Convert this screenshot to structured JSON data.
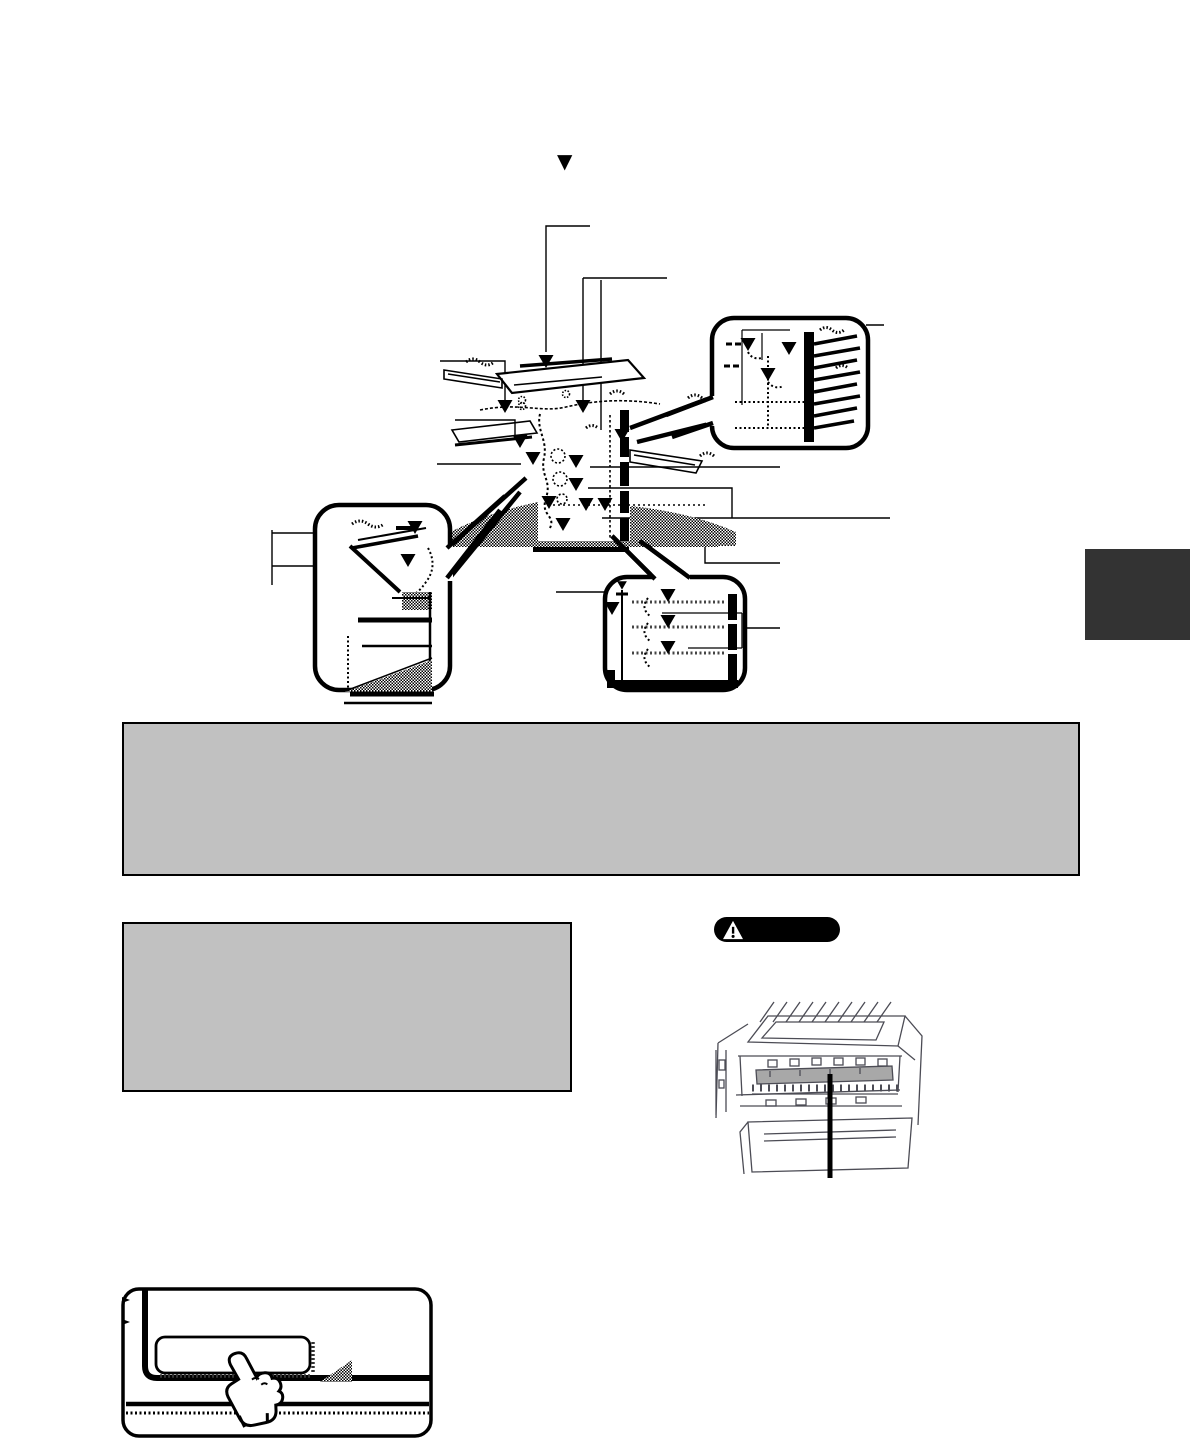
{
  "page": {
    "background": "#ffffff",
    "width": 1190,
    "height": 1441
  },
  "header": {
    "bullet_glyph": "▼"
  },
  "diagram": {
    "title": "misfeed-locations-diagram",
    "marker_glyph": "▼",
    "marker_color": "#000000",
    "insets": [
      {
        "name": "finisher-tray-detail"
      },
      {
        "name": "duplex-module-detail"
      },
      {
        "name": "paper-tray-detail"
      }
    ]
  },
  "note_boxes": {
    "primary": {
      "fill": "#c1c1c1",
      "border": "#000000",
      "text": ""
    },
    "secondary": {
      "fill": "#c1c1c1",
      "border": "#000000",
      "text": ""
    }
  },
  "caution_label": {
    "bg": "#000000",
    "icon": "warning-triangle-icon",
    "icon_color": "#ffffff",
    "text": ""
  },
  "fusing_illustration": {
    "line_color": "#4c4c55",
    "highlight_fill": "#a8a8a8",
    "callout_color": "#000000"
  },
  "touch_panel_illustration": {
    "line_color": "#000000",
    "button_fill": "#ffffff"
  },
  "section_tab": {
    "color": "#333333"
  }
}
